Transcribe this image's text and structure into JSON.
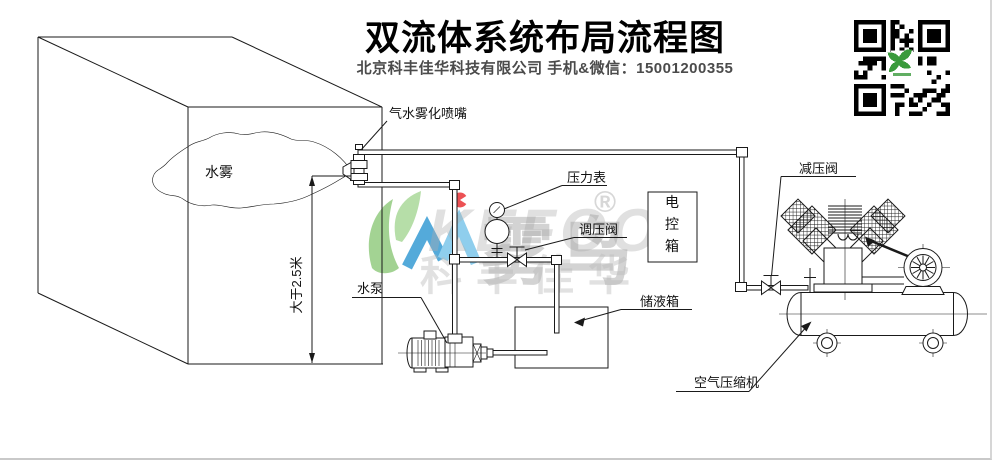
{
  "header": {
    "title": "双流体系统布局流程图",
    "subtitle": "北京科丰佳华科技有限公司 手机&微信：15001200355"
  },
  "labels": {
    "nozzle": "气水雾化喷嘴",
    "water_mist": "水雾",
    "min_height": "大于2.5米",
    "pressure_gauge": "压力表",
    "regulating_valve": "调压阀",
    "control_box": "电控箱",
    "storage_tank": "储液箱",
    "water_pump": "水泵",
    "reducing_valve": "减压阀",
    "air_compressor": "空气压缩机"
  },
  "watermark": {
    "brand_latin": "KEFOO",
    "brand_cn": "雾鸟",
    "company_short": "科丰佳华",
    "registered": "®"
  },
  "colors": {
    "line": "#1a1a1a",
    "leaf_green": "#8cc878",
    "logo_blue": "#2a95d2",
    "logo_light_blue": "#74c3e9",
    "logo_red": "#e8262a",
    "watermark_grey": "#9a9a9a",
    "qr_green": "#3a9a3c"
  }
}
